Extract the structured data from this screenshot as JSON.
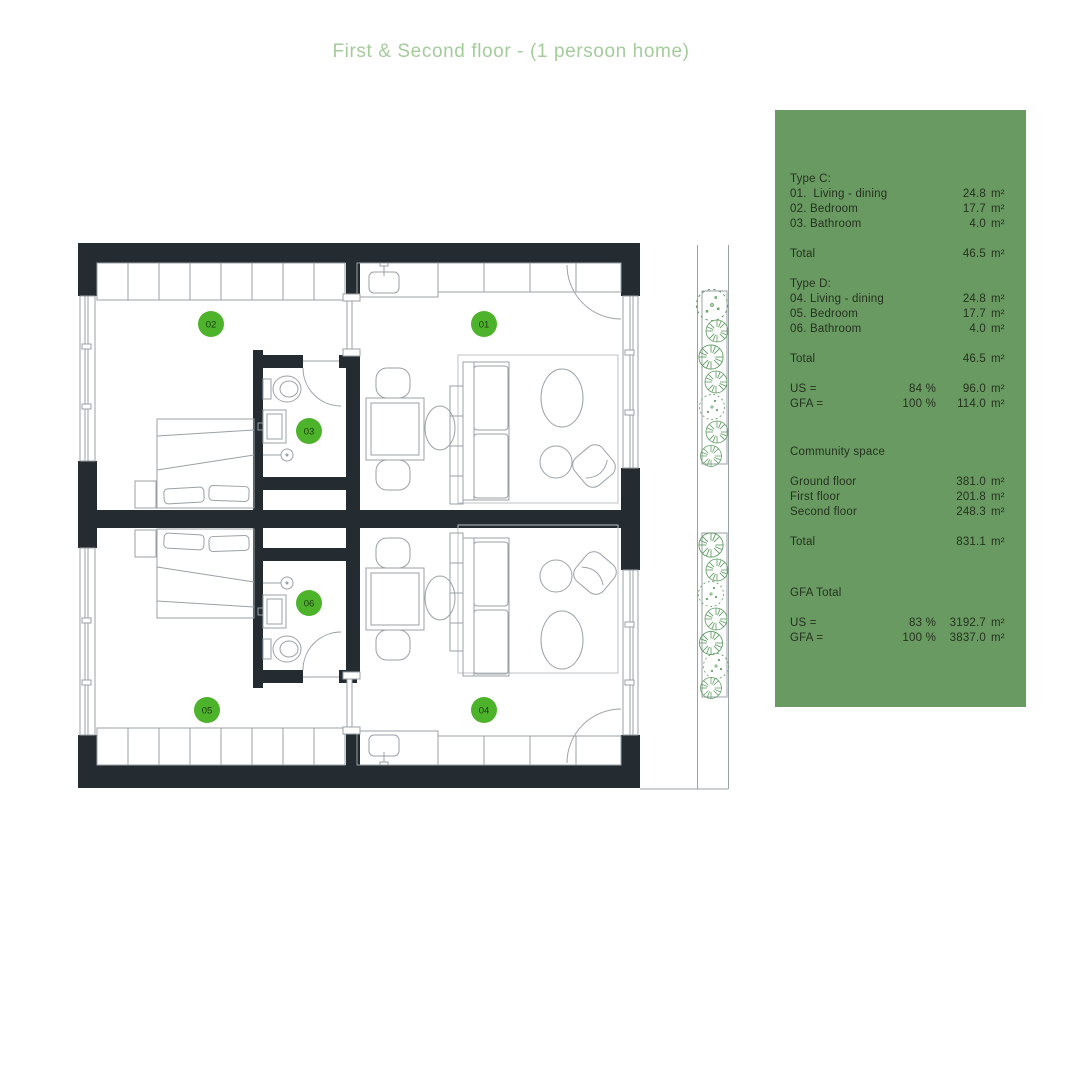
{
  "title": "First & Second floor - (1 persoon home)",
  "colors": {
    "panel_bg": "#689a62",
    "panel_text": "#26321f",
    "title_green": "#a4cc9b",
    "marker_green": "#4cb32a",
    "marker_text": "#1e3a10",
    "wall_dark": "#242c31",
    "line_gray": "#9aa1a7",
    "plant_green": "#5d9c60"
  },
  "plan": {
    "markers": [
      {
        "label": "01"
      },
      {
        "label": "02"
      },
      {
        "label": "03"
      },
      {
        "label": "04"
      },
      {
        "label": "05"
      },
      {
        "label": "06"
      }
    ]
  },
  "panel": {
    "type_c": {
      "header": "Type C:",
      "rows": [
        {
          "label": "01.  Living - dining",
          "value": "24.8",
          "unit": "m²"
        },
        {
          "label": "02. Bedroom",
          "value": "17.7",
          "unit": "m²"
        },
        {
          "label": "03. Bathroom",
          "value": "4.0",
          "unit": "m²"
        }
      ],
      "total": {
        "label": "Total",
        "value": "46.5",
        "unit": "m²"
      }
    },
    "type_d": {
      "header": "Type D:",
      "rows": [
        {
          "label": "04. Living - dining",
          "value": "24.8",
          "unit": "m²"
        },
        {
          "label": "05. Bedroom",
          "value": "17.7",
          "unit": "m²"
        },
        {
          "label": "06. Bathroom",
          "value": "4.0",
          "unit": "m²"
        }
      ],
      "total": {
        "label": "Total",
        "value": "46.5",
        "unit": "m²"
      }
    },
    "unit_ratios": [
      {
        "label": "US =",
        "percent": "84 %",
        "value": "96.0",
        "unit": "m²"
      },
      {
        "label": "GFA =",
        "percent": "100 %",
        "value": "114.0",
        "unit": "m²"
      }
    ],
    "community": {
      "header": "Community space",
      "rows": [
        {
          "label": "Ground floor",
          "value": "381.0",
          "unit": "m²"
        },
        {
          "label": "First floor",
          "value": "201.8",
          "unit": "m²"
        },
        {
          "label": "Second floor",
          "value": "248.3",
          "unit": "m²"
        }
      ],
      "total": {
        "label": "Total",
        "value": "831.1",
        "unit": "m²"
      }
    },
    "gfa_total": {
      "header": "GFA Total",
      "rows": [
        {
          "label": "US =",
          "percent": "83 %",
          "value": "3192.7",
          "unit": "m²"
        },
        {
          "label": "GFA =",
          "percent": "100 %",
          "value": "3837.0",
          "unit": "m²"
        }
      ]
    }
  }
}
